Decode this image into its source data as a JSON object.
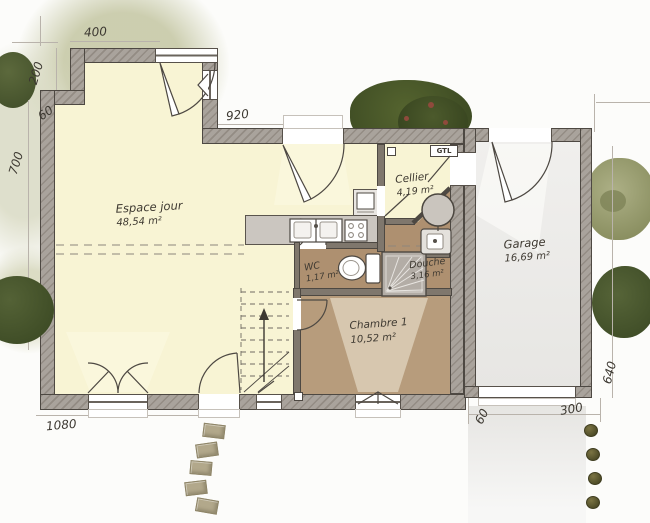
{
  "plan": {
    "rooms": {
      "espace_jour": {
        "name": "Espace jour",
        "area": "48,54 m²"
      },
      "cellier": {
        "name": "Cellier",
        "area": "4,19 m²"
      },
      "garage": {
        "name": "Garage",
        "area": "16,69 m²"
      },
      "wc": {
        "name": "WC",
        "area": "1,17 m²"
      },
      "douche": {
        "name": "Douche",
        "area": "3,16 m²"
      },
      "chambre1": {
        "name": "Chambre 1",
        "area": "10,52 m²"
      }
    },
    "annotations": {
      "gtl": "GTL"
    },
    "dimensions_cm": {
      "top_window_width": "400",
      "upper_left_height": "200",
      "left_jog": "60",
      "left_wall_height": "700",
      "top_wall_width": "920",
      "bottom_wall_width": "1080",
      "garage_offset": "60",
      "garage_door_width": "300",
      "garage_side_depth": "640"
    },
    "colors": {
      "living_floor": "#f8f4d4",
      "wet_floor": "#ae9070",
      "bedroom_floor": "#b79c7c",
      "garage_floor": "#efeeec",
      "wall_fill": "#a9a39c",
      "wall_line": "#4d4842",
      "greenery_dark": "#4c5a31",
      "greenery_light": "#c7c9a7"
    }
  }
}
